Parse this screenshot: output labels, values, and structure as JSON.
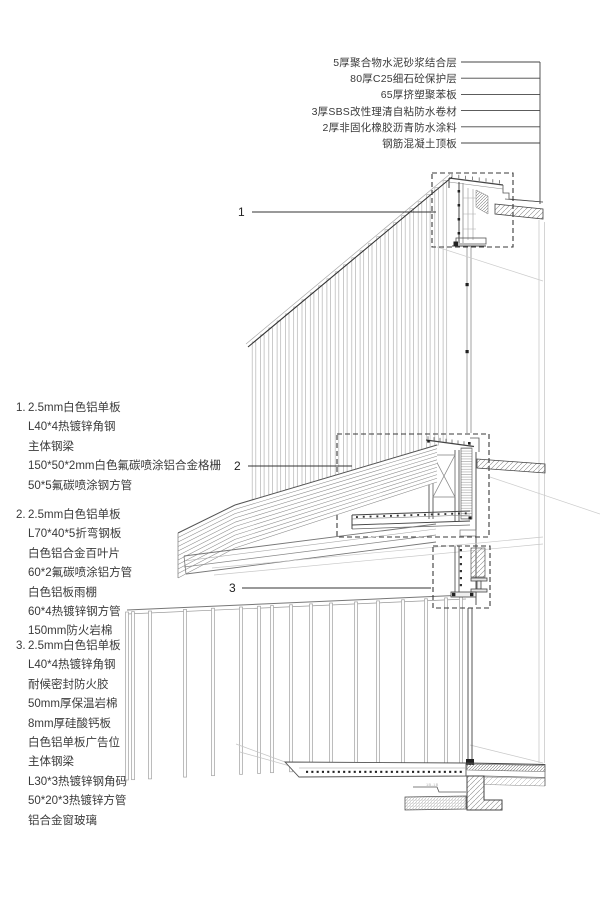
{
  "roof_layers": [
    "5厚聚合物水泥砂浆结合层",
    "80厚C25细石砼保护层",
    "65厚挤塑聚苯板",
    "3厚SBS改性理清自粘防水卷材",
    "2厚非固化橡胶沥青防水涂料",
    "钢筋混凝土顶板"
  ],
  "markers": {
    "m1": "1",
    "m2": "2",
    "m3": "3"
  },
  "notes": {
    "blocks": [
      {
        "num": "1.",
        "lines": [
          "2.5mm白色铝单板",
          "L40*4热镀锌角钢",
          "主体钢梁",
          "150*50*2mm白色氟碳喷涂铝合金格栅",
          "50*5氟碳喷涂钢方管"
        ]
      },
      {
        "num": "2.",
        "lines": [
          "2.5mm白色铝单板",
          "L70*40*5折弯钢板",
          "白色铝合金百叶片",
          "60*2氟碳喷涂铝方管",
          "白色铝板雨棚",
          "60*4热镀锌钢方管",
          "150mm防火岩棉"
        ]
      },
      {
        "num": "3.",
        "lines": [
          "2.5mm白色铝单板",
          "L40*4热镀锌角钢",
          "耐候密封防火胶",
          "50mm厚保温岩棉",
          "8mm厚硅酸钙板",
          "白色铝单板广告位",
          "主体钢梁",
          "L30*3热镀锌钢角码",
          "50*20*3热镀锌方管",
          "铝合金窗玻璃"
        ]
      }
    ]
  },
  "drawing": {
    "tiny_ref": "1B-1B"
  },
  "colors": {
    "line_dark": "#333333",
    "line_mid": "#777777",
    "line_light": "#bbbbbb",
    "text": "#3a3a3a"
  }
}
